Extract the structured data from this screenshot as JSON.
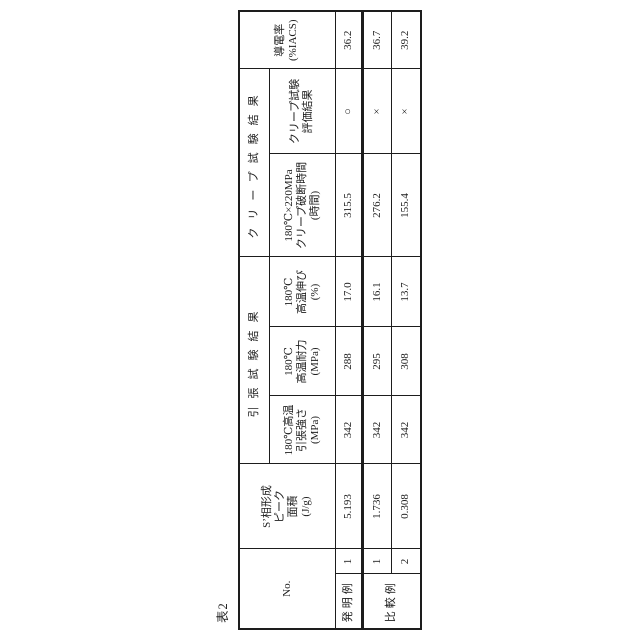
{
  "title": "表2",
  "colors": {
    "background": "#ffffff",
    "border": "#1d1d1d",
    "text": "#1d1d1d"
  },
  "table": {
    "header": {
      "no": "No.",
      "s_phase_area": {
        "l1": "S’相形成",
        "l2": "ピーク",
        "l3": "面積",
        "l4": "(J/g)"
      },
      "tensile_group": "引張試験結果",
      "tensile_strength": {
        "l1": "180℃高温",
        "l2": "引張強さ",
        "l3": "(MPa)"
      },
      "proof_stress": {
        "l1": "180℃",
        "l2": "高温耐力",
        "l3": "(MPa)"
      },
      "elongation": {
        "l1": "180℃",
        "l2": "高温伸び",
        "l3": "(%)"
      },
      "creep_group": "クリープ試験結果",
      "creep_rupture": {
        "l1": "180℃×220MPa",
        "l2": "クリープ破断時間",
        "l3": "(時間)"
      },
      "creep_eval": {
        "l1": "クリープ試験",
        "l2": "評価結果"
      },
      "conductivity": {
        "l1": "導電率",
        "l2": "(%IACS)"
      }
    },
    "rows": [
      {
        "group": "発明例",
        "no": "1",
        "s_phase": "5.193",
        "strength": "342",
        "proof": "288",
        "elong": "17.0",
        "rupture": "315.5",
        "eval": "○",
        "cond": "36.2"
      },
      {
        "group": "比較例",
        "no": "1",
        "s_phase": "1.736",
        "strength": "342",
        "proof": "295",
        "elong": "16.1",
        "rupture": "276.2",
        "eval": "×",
        "cond": "36.7"
      },
      {
        "group": "",
        "no": "2",
        "s_phase": "0.308",
        "strength": "342",
        "proof": "308",
        "elong": "13.7",
        "rupture": "155.4",
        "eval": "×",
        "cond": "39.2"
      }
    ]
  }
}
